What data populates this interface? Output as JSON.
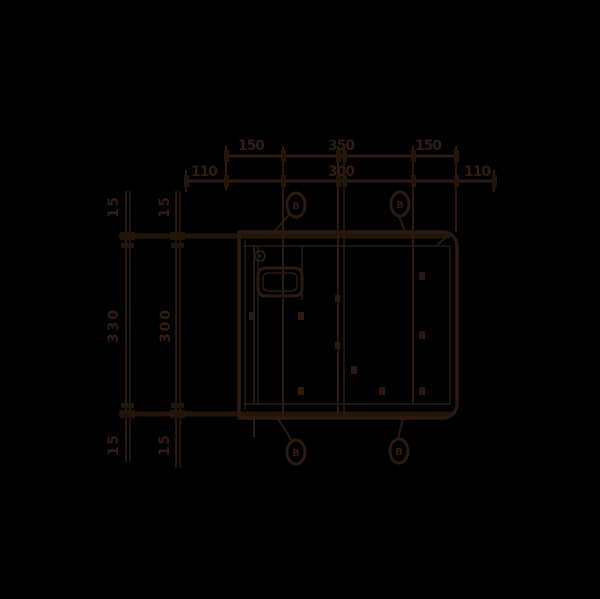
{
  "drawing": {
    "background": "#000000",
    "line_color": "#2b1a11",
    "top_dims_row1": [
      "150",
      "350",
      "150"
    ],
    "top_dims_row2": [
      "110",
      "300",
      "110"
    ],
    "left_dims_outer": {
      "top": "15",
      "middle": "330",
      "bottom": "15"
    },
    "left_dims_inner": {
      "top": "15",
      "middle": "300",
      "bottom": "15"
    },
    "balloons": {
      "top_left": "B",
      "top_right": "B",
      "bottom_left": "B",
      "bottom_right": "B"
    }
  }
}
